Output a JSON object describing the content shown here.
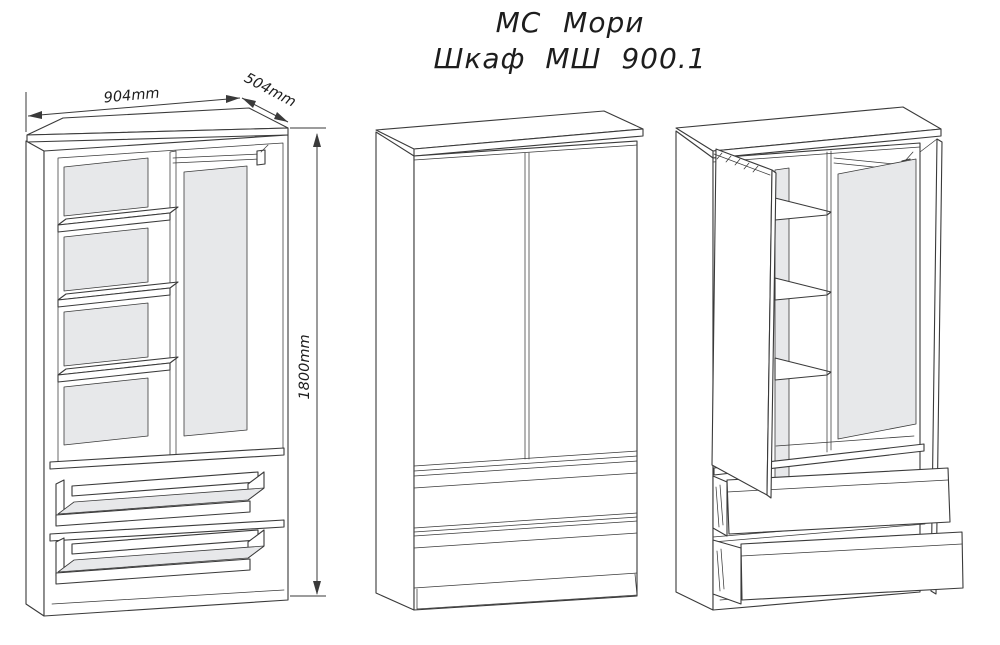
{
  "title": {
    "line1": "МС Мори",
    "line2": "Шкаф МШ 900.1"
  },
  "dimensions": {
    "width_label": "904mm",
    "depth_label": "504mm",
    "height_label": "1800mm"
  },
  "colors": {
    "line": "#3a3a3a",
    "panel_fill": "#e7e8ea",
    "background": "#ffffff",
    "text": "#1d1d1d"
  }
}
